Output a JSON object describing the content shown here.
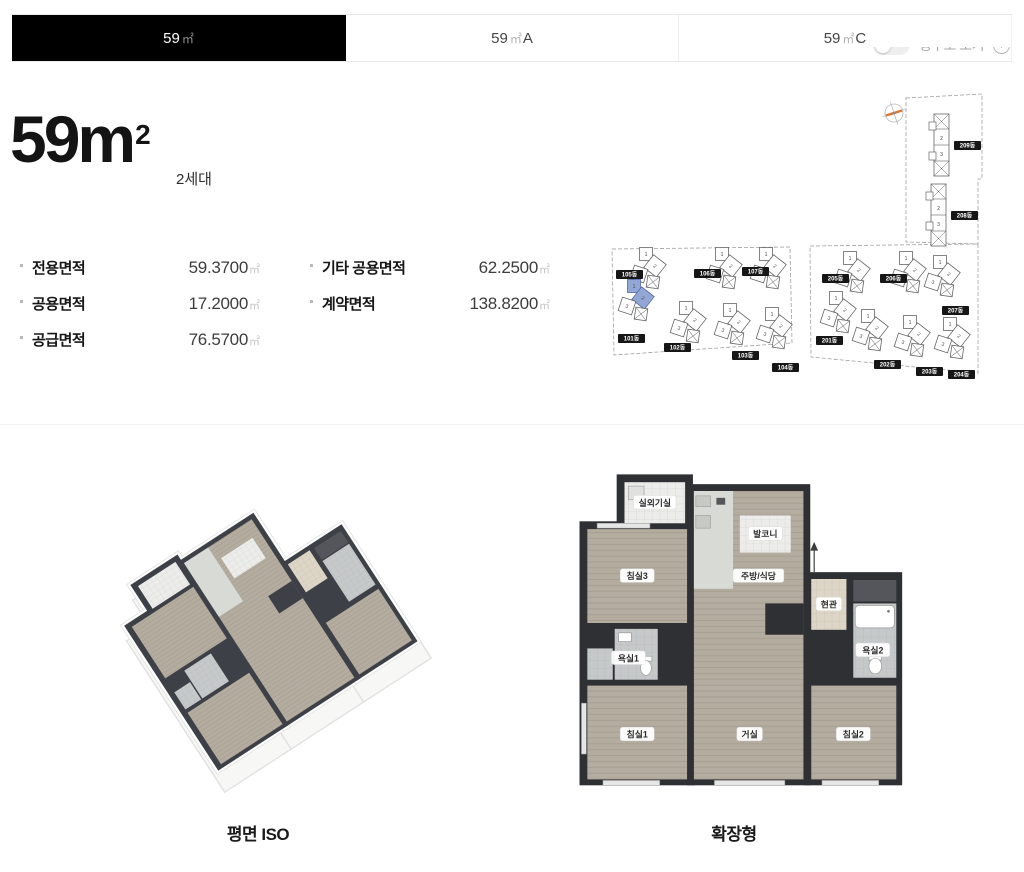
{
  "tabs": [
    {
      "num": "59",
      "unit": "㎡",
      "variant": "",
      "active": true
    },
    {
      "num": "59",
      "unit": "㎡",
      "variant": "A",
      "active": false
    },
    {
      "num": "59",
      "unit": "㎡",
      "variant": "C",
      "active": false
    }
  ],
  "view_toggle": {
    "label": "평수로 보기",
    "info_icon": "ⓘ"
  },
  "unit": {
    "title_num": "59m",
    "title_sup": "2",
    "households": "2세대"
  },
  "areas": {
    "left": [
      {
        "label": "전용면적",
        "value": "59.3700",
        "unit": "㎡"
      },
      {
        "label": "공용면적",
        "value": "17.2000",
        "unit": "㎡"
      },
      {
        "label": "공급면적",
        "value": "76.5700",
        "unit": "㎡"
      }
    ],
    "right": [
      {
        "label": "기타 공용면적",
        "value": "62.2500",
        "unit": "㎡"
      },
      {
        "label": "계약면적",
        "value": "138.8200",
        "unit": "㎡"
      }
    ]
  },
  "site_plan": {
    "highlighted": "101동",
    "highlight_color": "#93a7d6",
    "buildings": [
      "105동",
      "106동",
      "107동",
      "101동",
      "102동",
      "103동",
      "104동",
      "209동",
      "208동",
      "205동",
      "206동",
      "207동",
      "201동",
      "202동",
      "203동",
      "204동"
    ]
  },
  "floor_plans": {
    "iso": {
      "caption": "평면 ISO"
    },
    "extended": {
      "caption": "확장형",
      "rooms": {
        "outdoor_unit": "실외기실",
        "bedroom3": "침실3",
        "balcony": "발코니",
        "kitchen": "주방/식당",
        "entry": "현관",
        "bath2": "욕실2",
        "bath1": "욕실1",
        "bedroom1": "침실1",
        "living": "거실",
        "bedroom2": "침실2"
      }
    }
  },
  "colors": {
    "tab_active_bg": "#000000",
    "wall": "#2f3034",
    "wood_floor": "#b3ac9f"
  }
}
